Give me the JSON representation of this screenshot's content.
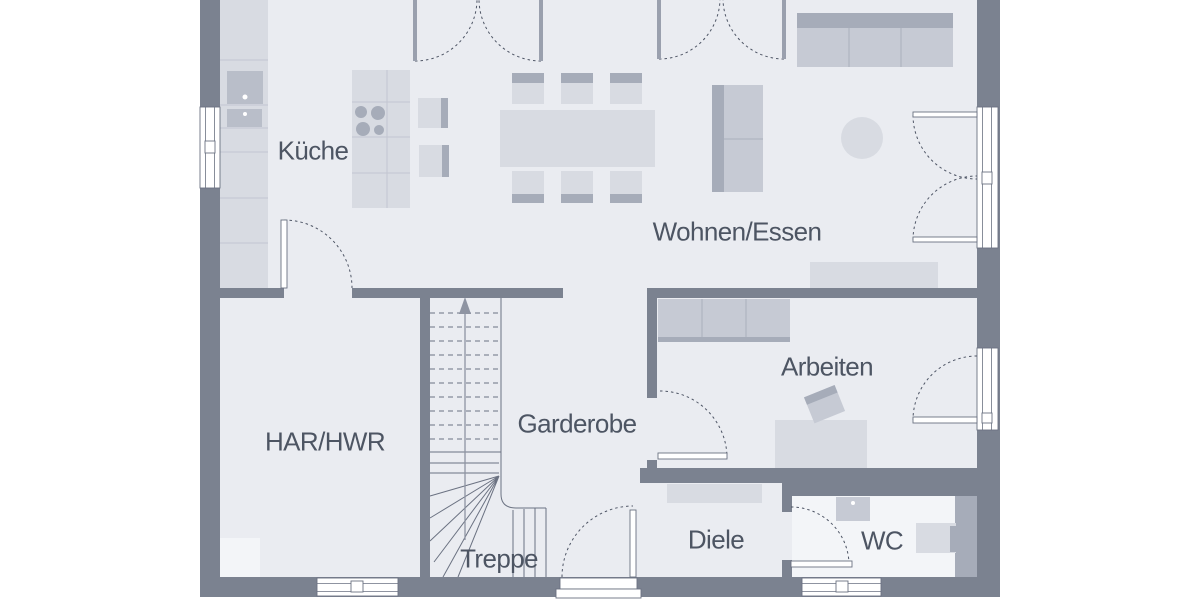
{
  "plan": {
    "type": "floor-plan",
    "rooms": {
      "kueche": "Küche",
      "wohnen_essen": "Wohnen/Essen",
      "har_hwr": "HAR/HWR",
      "garderobe": "Garderobe",
      "treppe": "Treppe",
      "arbeiten": "Arbeiten",
      "diele": "Diele",
      "wc": "WC"
    }
  },
  "palette": {
    "wall": "#7b8290",
    "floor": "#eaecf1",
    "floor_light": "#f3f5f8",
    "furniture": "#d8dbe2",
    "furniture_mid": "#c6cad4",
    "furniture_dark": "#a6acb9",
    "appliance": "#b9bec9",
    "line": "#6b7282",
    "arc": "#4e5565",
    "text": "#4d5563"
  }
}
